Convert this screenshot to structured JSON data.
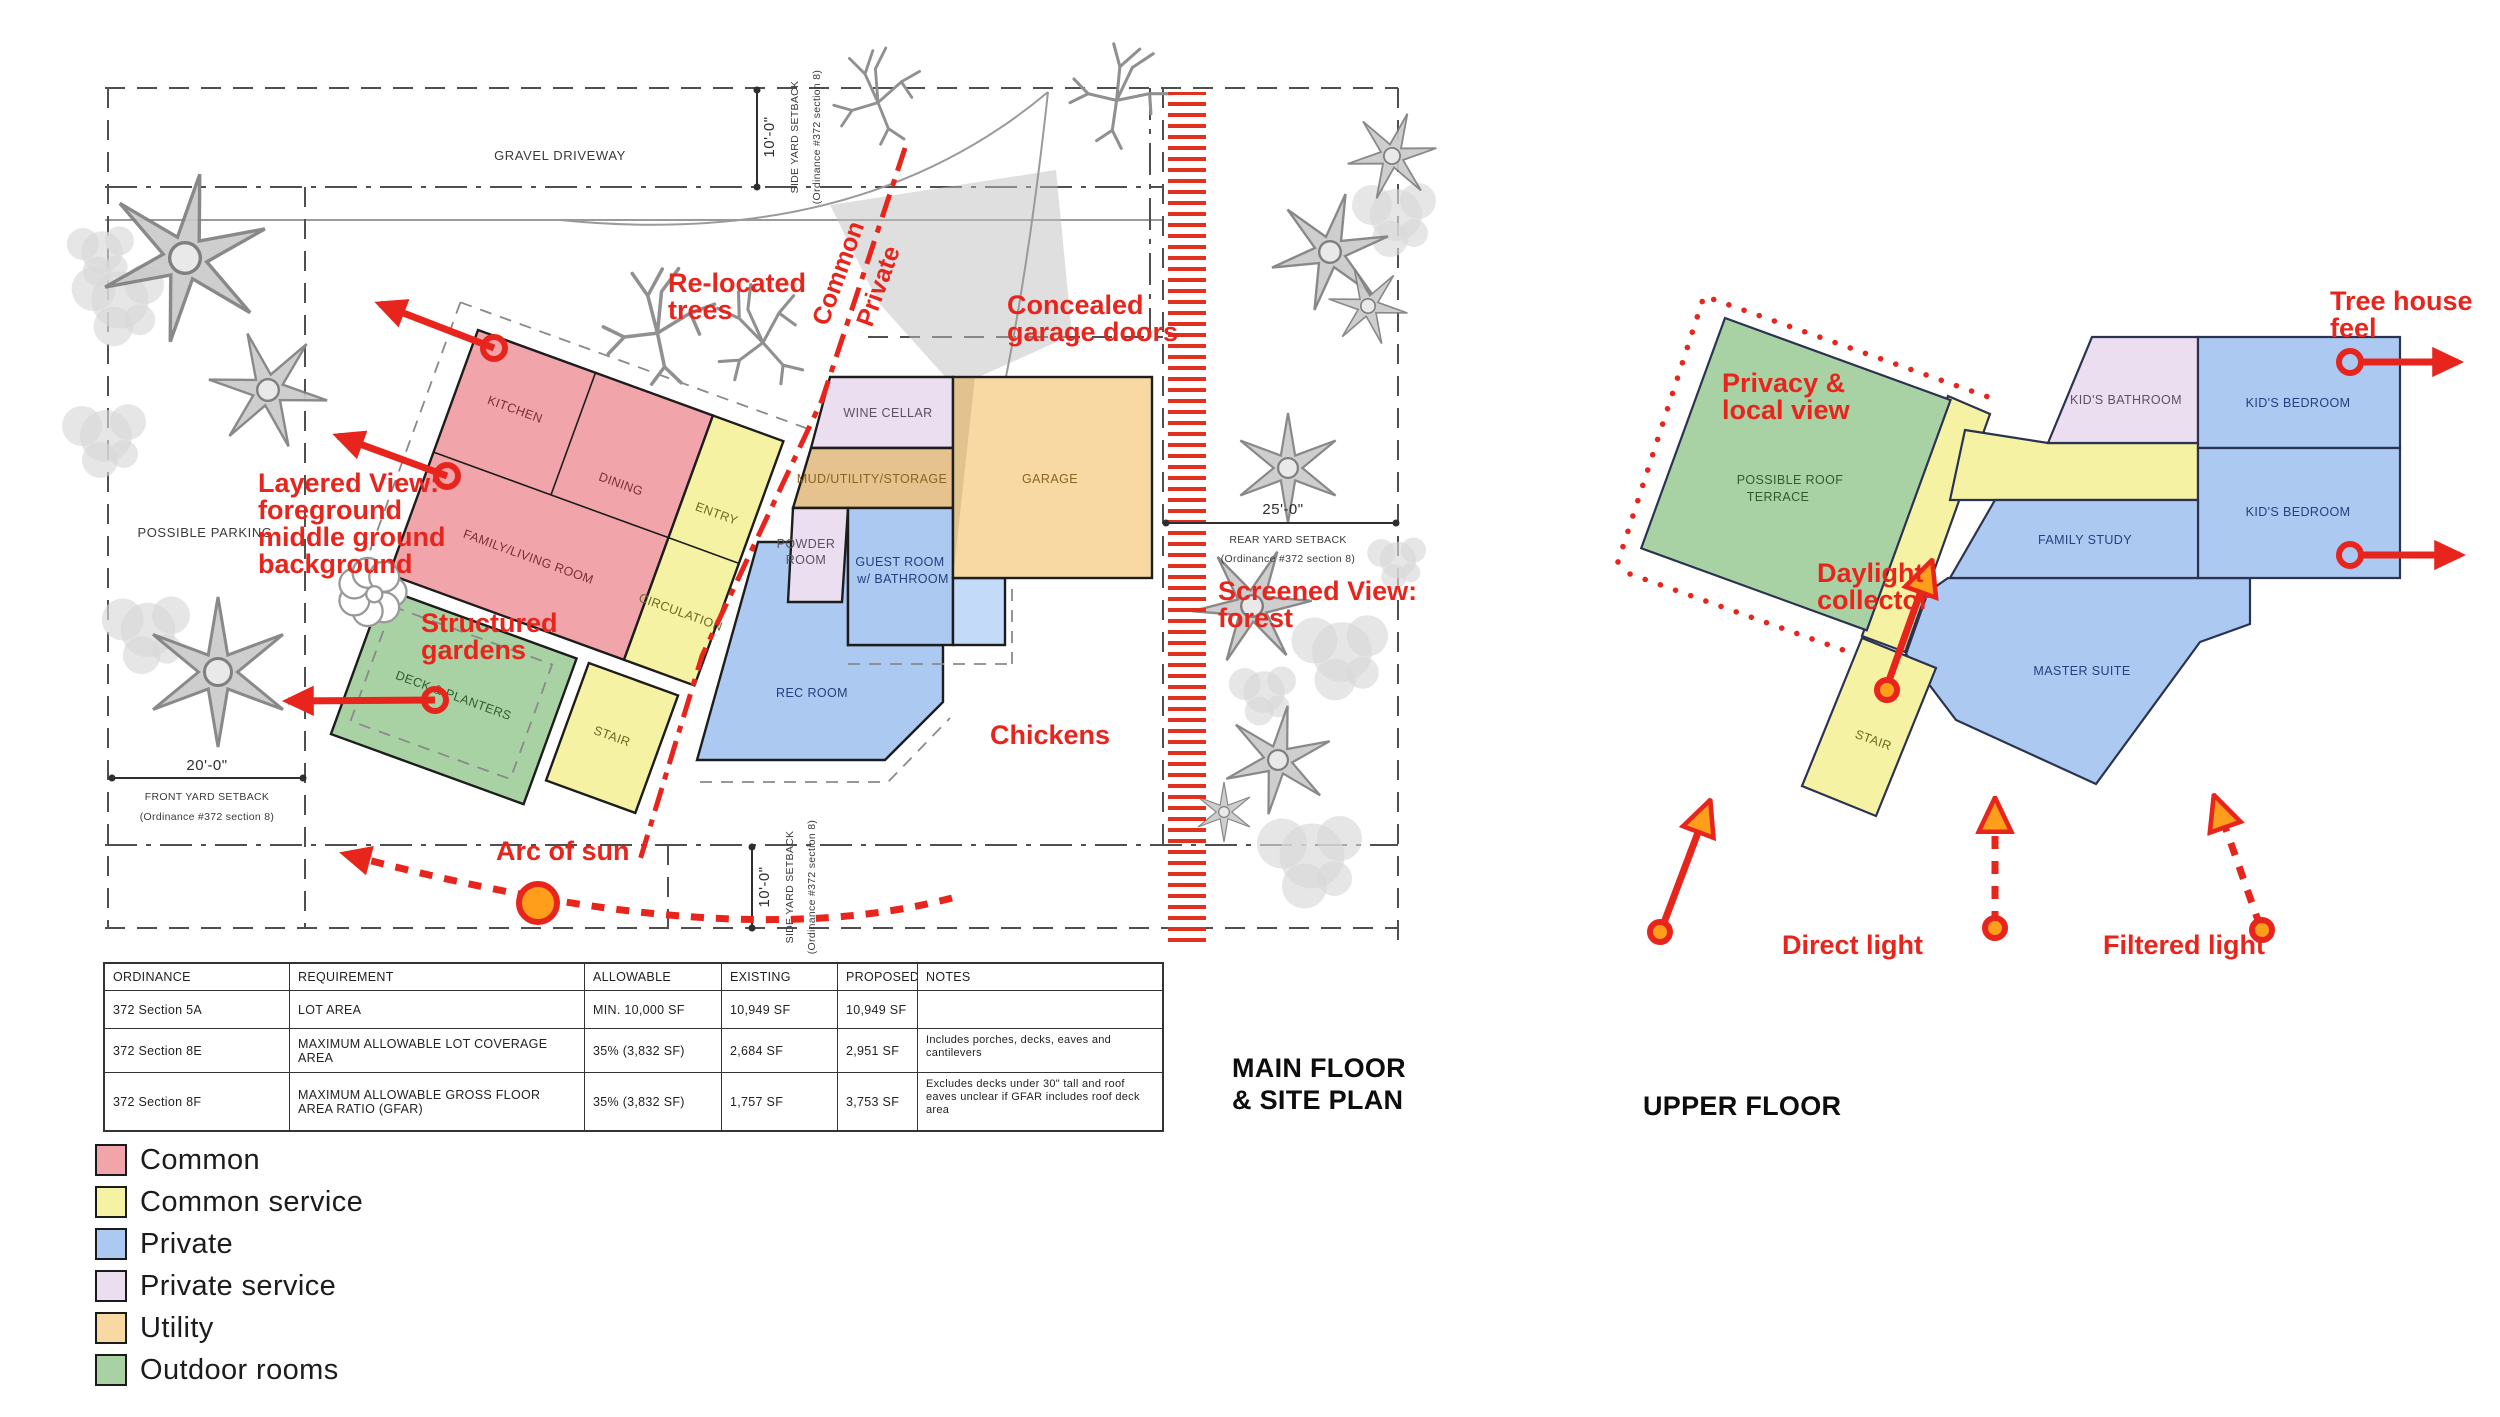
{
  "colors": {
    "red": "#E8251D",
    "orange": "#FF9E1B",
    "common": "#F2A4AB",
    "common_service": "#F5F2A3",
    "private": "#ABC9F1",
    "private_service": "#ECDEF1",
    "utility": "#F8D8A3",
    "outdoor_rooms": "#A9D2A4"
  },
  "titles": {
    "main_1": "MAIN FLOOR",
    "main_2": "& SITE PLAN",
    "upper": "UPPER FLOOR"
  },
  "legend": [
    {
      "label": "Common",
      "color": "#F2A4AB"
    },
    {
      "label": "Common service",
      "color": "#F5F2A3"
    },
    {
      "label": "Private",
      "color": "#ABC9F1"
    },
    {
      "label": "Private service",
      "color": "#ECDEF1"
    },
    {
      "label": "Utility",
      "color": "#F8D8A3"
    },
    {
      "label": "Outdoor rooms",
      "color": "#A9D2A4"
    }
  ],
  "table": {
    "headers": [
      "ORDINANCE",
      "REQUIREMENT",
      "ALLOWABLE",
      "EXISTING",
      "PROPOSED",
      "NOTES"
    ],
    "rows": [
      [
        "372 Section 5A",
        "LOT AREA",
        "MIN. 10,000 SF",
        "10,949 SF",
        "10,949 SF",
        ""
      ],
      [
        "372 Section 8E",
        "MAXIMUM ALLOWABLE LOT COVERAGE AREA",
        "35% (3,832 SF)",
        "2,684 SF",
        "2,951 SF",
        "Includes porches, decks, eaves and cantilevers"
      ],
      [
        "372 Section 8F",
        "MAXIMUM ALLOWABLE GROSS FLOOR AREA RATIO (GFAR)",
        "35% (3,832 SF)",
        "1,757 SF",
        "3,753 SF",
        "Excludes decks under 30\" tall and roof eaves unclear if GFAR includes roof deck area"
      ]
    ]
  },
  "main_plan": {
    "site_labels": {
      "gravel": "GRAVEL DRIVEWAY",
      "parking": "POSSIBLE PARKING"
    },
    "setbacks": {
      "side_top": {
        "dim": "10'-0\"",
        "name": "SIDE YARD SETBACK",
        "ord": "(Ordinance #372 section 8)"
      },
      "side_bottom": {
        "dim": "10'-0\"",
        "name": "SIDE YARD SETBACK",
        "ord": "(Ordinance #372 section 8)"
      },
      "front": {
        "dim": "20'-0\"",
        "name": "FRONT YARD SETBACK",
        "ord": "(Ordinance #372 section 8)"
      },
      "rear": {
        "dim": "25'-0\"",
        "name": "REAR YARD SETBACK",
        "ord": "(Ordinance #372 section 8)"
      }
    },
    "rooms": {
      "kitchen": "KITCHEN",
      "dining": "DINING",
      "family": "FAMILY/LIVING ROOM",
      "entry": "ENTRY",
      "circulation": "CIRCULATION",
      "wine": "WINE CELLAR",
      "mud": "MUD/UTILITY/STORAGE",
      "powder_1": "POWDER",
      "powder_2": "ROOM",
      "guest_1": "GUEST ROOM",
      "guest_2": "w/ BATHROOM",
      "garage": "GARAGE",
      "rec": "REC ROOM",
      "deck": "DECK & PLANTERS",
      "stair": "STAIR"
    },
    "annotations": {
      "relocated": [
        "Re-located",
        "trees"
      ],
      "common": "Common",
      "private": "Private",
      "concealed": [
        "Concealed",
        "garage doors"
      ],
      "layered": [
        "Layered View:",
        "foreground",
        "middle ground",
        "background"
      ],
      "structured": [
        "Structured",
        "gardens"
      ],
      "screened": [
        "Screened View:",
        "forest"
      ],
      "chickens": "Chickens",
      "arc": "Arc of sun"
    }
  },
  "upper_plan": {
    "rooms": {
      "terrace_1": "POSSIBLE ROOF",
      "terrace_2": "TERRACE",
      "bathroom": "KID'S BATHROOM",
      "bedroom_top": "KID'S BEDROOM",
      "bedroom_bottom": "KID'S BEDROOM",
      "study": "FAMILY STUDY",
      "master": "MASTER SUITE",
      "stair": "STAIR"
    },
    "annotations": {
      "privacy": [
        "Privacy &",
        "local view"
      ],
      "daylight": [
        "Daylight",
        "collector"
      ],
      "treehouse": [
        "Tree house",
        "feel"
      ],
      "direct": "Direct light",
      "filtered": "Filtered light"
    }
  }
}
